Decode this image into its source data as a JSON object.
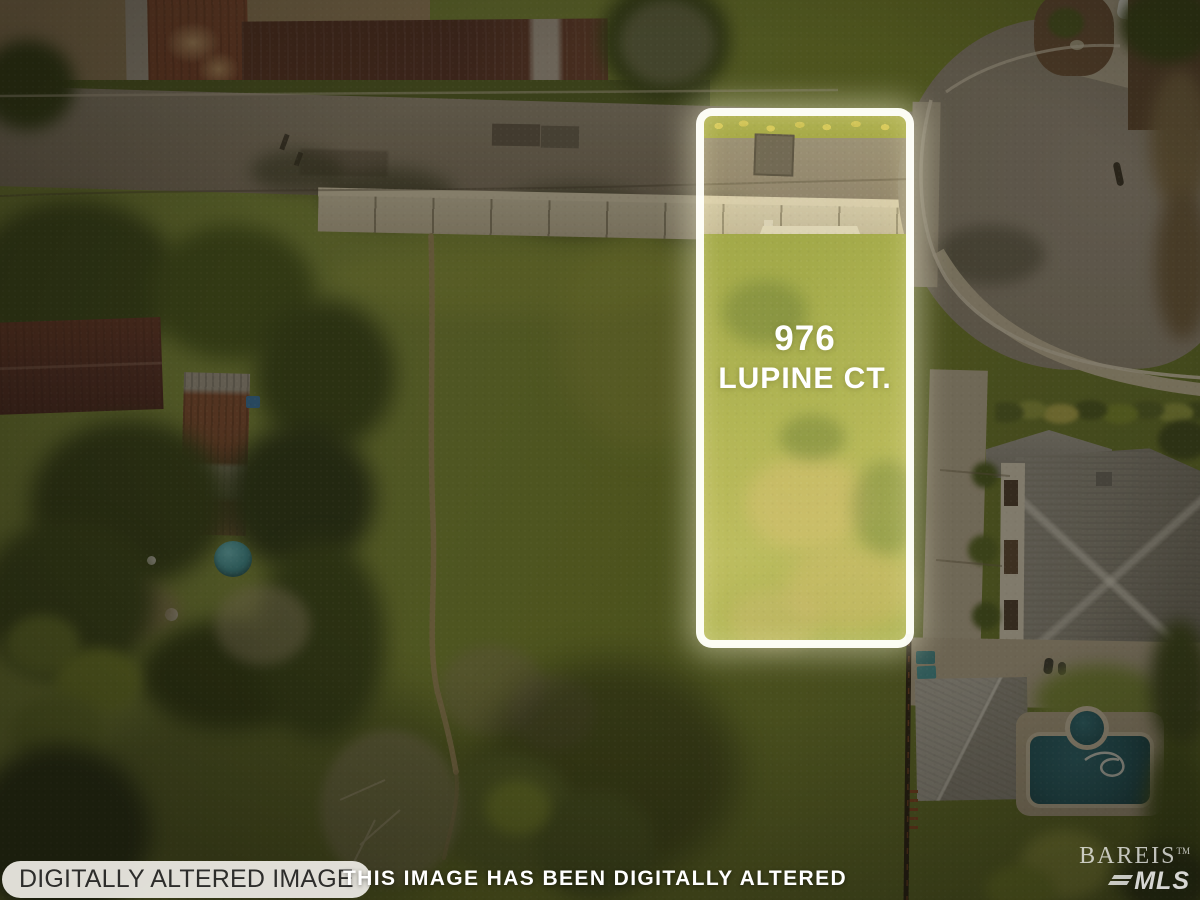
{
  "lot_label": {
    "line1": "976",
    "line2": "LUPINE CT."
  },
  "watermarks": {
    "badge_bottom_left": "DIGITALLY ALTERED IMAGE",
    "banner_bottom_center": "THIS IMAGE HAS BEEN DIGITALLY ALTERED",
    "logo": {
      "name": "BAREIS",
      "trademark": "TM",
      "suffix": "MLS"
    }
  },
  "colors": {
    "outline_white": "#fffffa",
    "lot_grass": "#a9b14c",
    "meadow": "#7d8c3e",
    "road_asphalt": "#96897a",
    "culdesac_asphalt": "#8d8578",
    "sidewalk_concrete": "#cdc4ab",
    "barn_rust": "#8a5038",
    "house_roof_gray": "#8b8982",
    "pool_water": "#1f5a68",
    "darken_overlay": "rgba(16,13,6,0.40)"
  }
}
